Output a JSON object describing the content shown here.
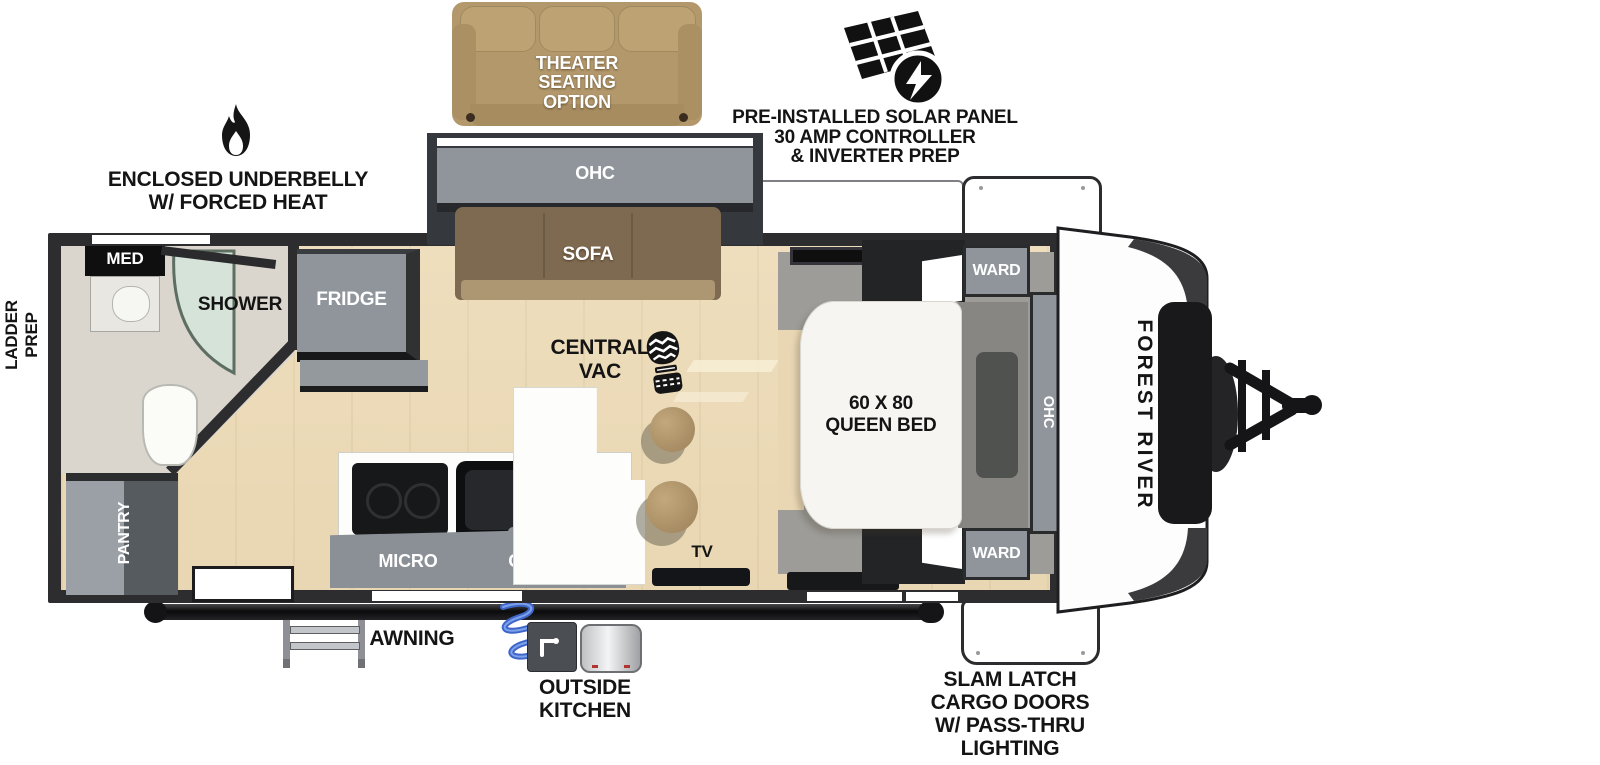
{
  "callouts": {
    "theater_seating": [
      "THEATER",
      "SEATING",
      "OPTION"
    ],
    "solar": [
      "PRE-INSTALLED SOLAR PANEL",
      "30 AMP CONTROLLER",
      "& INVERTER PREP"
    ],
    "underbelly": [
      "ENCLOSED UNDERBELLY",
      "W/ FORCED HEAT"
    ],
    "ladder_prep": [
      "LADDER",
      "PREP"
    ],
    "awning": "AWNING",
    "outside_kitchen": [
      "OUTSIDE",
      "KITCHEN"
    ],
    "slam_latch": [
      "SLAM LATCH",
      "CARGO DOORS",
      "W/ PASS-THRU",
      "LIGHTING"
    ]
  },
  "brand": "FOREST RIVER",
  "rooms": {
    "bathroom": {
      "med": "MED",
      "shower": "SHOWER"
    },
    "kitchen": {
      "fridge": "FRIDGE",
      "pantry": "PANTRY",
      "micro": "MICRO",
      "ohc": "OHC"
    },
    "living": {
      "ohc_slide": "OHC",
      "sofa": "SOFA",
      "central_vac": [
        "CENTRAL",
        "VAC"
      ],
      "tv": "TV"
    },
    "bedroom": {
      "ward_top": "WARD",
      "ward_bottom": "WARD",
      "bed": [
        "60 X 80",
        "QUEEN BED"
      ],
      "ohc": "OHC"
    }
  },
  "icons": {
    "solar": "solar-panel-icon",
    "underbelly": "flame-icon",
    "central_vac": "boot-print-icon"
  },
  "colors": {
    "wall": "#2d2d2f",
    "cabinet": "#8f959b",
    "floor": "#ecdcba",
    "sofa": "#7e6a50",
    "theater": "#b3986c",
    "bed": "#f6f5f1",
    "platform": "#9d9c98",
    "hose": "#3f66c9",
    "label": "#141414"
  }
}
